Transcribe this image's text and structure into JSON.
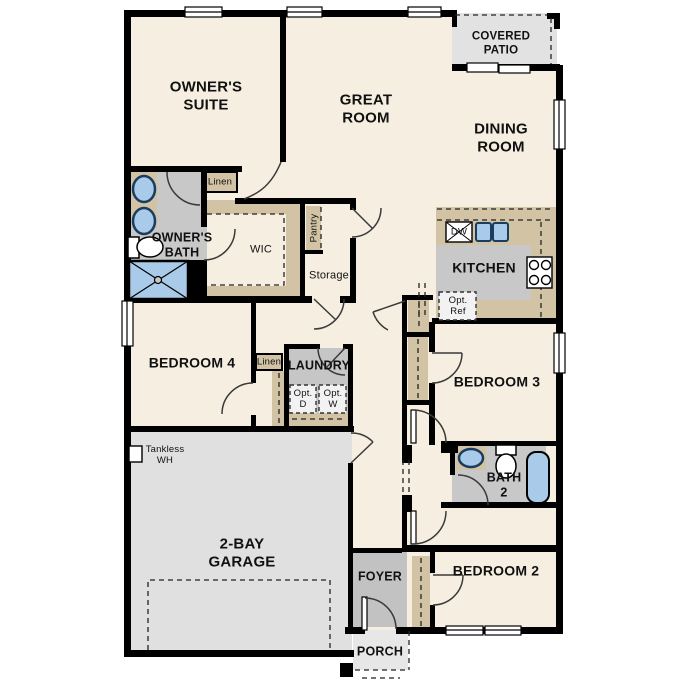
{
  "title": "Single-story floor plan",
  "labels": {
    "owners_suite": "OWNER'S\nSUITE",
    "great_room": "GREAT\nROOM",
    "dining_room": "DINING\nROOM",
    "covered_patio": "COVERED\nPATIO",
    "kitchen": "KITCHEN",
    "owners_bath": "OWNER'S\nBATH",
    "wic": "WIC",
    "linen_upper": "Linen",
    "linen_hall": "Linen",
    "pantry": "Pantry",
    "storage": "Storage",
    "bedroom_4": "BEDROOM 4",
    "laundry": "LAUNDRY",
    "opt_d": "Opt.\nD",
    "opt_w": "Opt.\nW",
    "opt_ref": "Opt.\nRef",
    "dw": "DW",
    "bedroom_3": "BEDROOM 3",
    "bath_2": "BATH\n2",
    "bedroom_2": "BEDROOM 2",
    "tankless_wh": "Tankless\nWH",
    "garage": "2-BAY\nGARAGE",
    "foyer": "FOYER",
    "porch": "PORCH"
  },
  "colors": {
    "wall": "#000000",
    "floor_cream": "#f6efe1",
    "cabinet_tan": "#d2c3a5",
    "floor_gray": "#c8c8c8",
    "foyer_gray": "#c2c2c2",
    "outdoor_gray": "#e2e2e2",
    "porch_gray": "#e7e7e7",
    "garage_gray": "#e0e0e0",
    "fixture_blue": "#a9cae9",
    "fixture_blue_edge": "#1a3c5e"
  }
}
